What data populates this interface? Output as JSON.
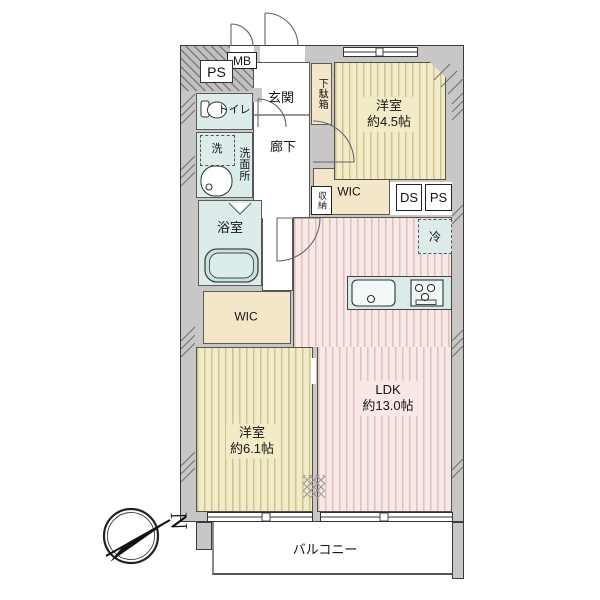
{
  "floorplan": {
    "labels": {
      "mb": "MB",
      "ps_top": "PS",
      "genkan": "玄関",
      "getabako": "下駄箱",
      "room45_name": "洋室",
      "room45_size": "約4.5帖",
      "toilet": "トイレ",
      "washer": "洗",
      "senmenjo": "洗面所",
      "rouka": "廊下",
      "yokushitsu": "浴室",
      "shunou": "収納",
      "wic_center": "WIC",
      "ds": "DS",
      "ps_right": "PS",
      "fridge": "冷",
      "wic_left": "WIC",
      "room61_name": "洋室",
      "room61_size": "約6.1帖",
      "ldk_name": "LDK",
      "ldk_size": "約13.0帖",
      "balcony": "バルコニー",
      "compass_north": "N"
    },
    "colors": {
      "wall": "#c8c7c5",
      "tatami_stripe_room": "#f2ebc8",
      "ldk_room": "#f8e8e6",
      "wet_area": "#dbeceb",
      "storage": "#f4e6c9",
      "outline": "#3c3c3c"
    }
  }
}
